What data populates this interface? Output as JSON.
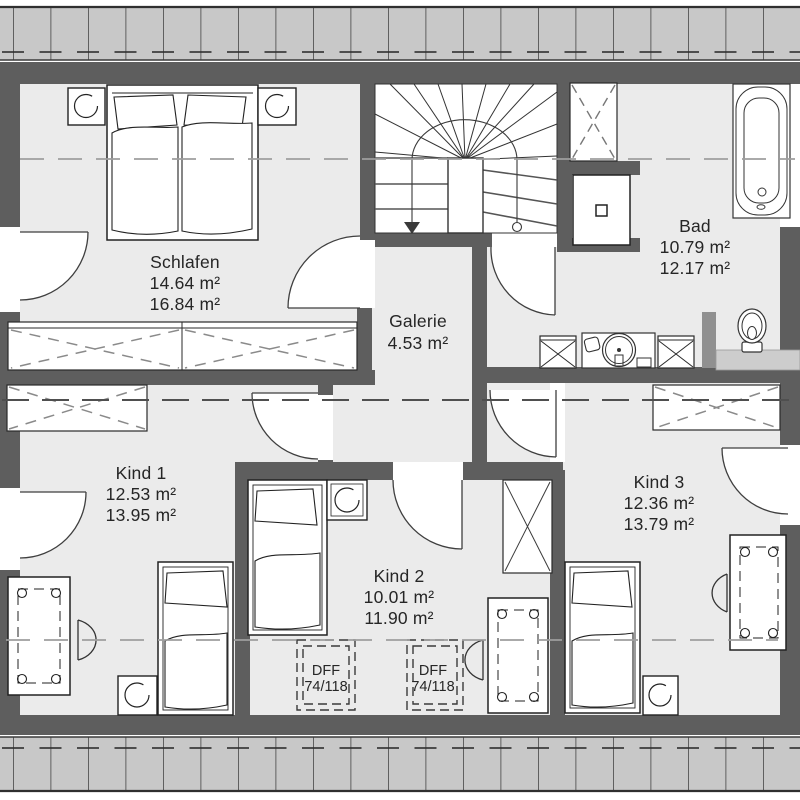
{
  "plan_title": "Dachgeschoss Grundriss",
  "rooms": {
    "schlafen": {
      "name": "Schlafen",
      "area1": "14.64 m²",
      "area2": "16.84 m²"
    },
    "galerie": {
      "name": "Galerie",
      "area1": "4.53 m²"
    },
    "bad": {
      "name": "Bad",
      "area1": "10.79 m²",
      "area2": "12.17 m²"
    },
    "kind1": {
      "name": "Kind 1",
      "area1": "12.53 m²",
      "area2": "13.95 m²"
    },
    "kind2": {
      "name": "Kind 2",
      "area1": "10.01 m²",
      "area2": "11.90 m²"
    },
    "kind3": {
      "name": "Kind 3",
      "area1": "12.36 m²",
      "area2": "13.79 m²"
    }
  },
  "roof_window": {
    "label": "DFF",
    "size": "74/118"
  },
  "colors": {
    "wall": "#5e5e5e",
    "floor": "#ebebeb",
    "roof_strip": "#c8c8c8",
    "stub_wall": "#909090",
    "platform": "#cdcdcd",
    "dash_line": "#9e9e9e"
  }
}
